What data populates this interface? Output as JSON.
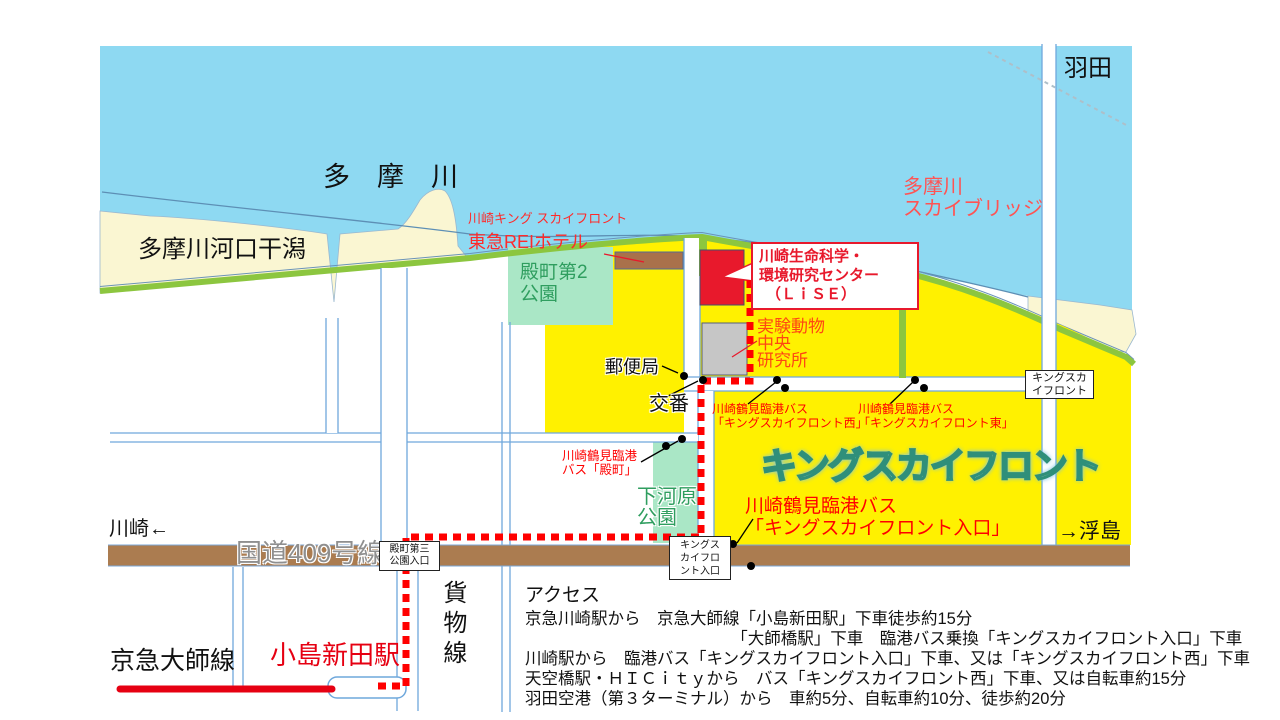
{
  "map": {
    "colors": {
      "river": "#8ed9f2",
      "sand": "#faf6d2",
      "shore_green": "#8cc63f",
      "district_yellow": "#fff100",
      "park_green": "#aae7c6",
      "road_brown": "#ab7c50",
      "road_line_blue": "#6fa8dc",
      "route_red": "#ff0000",
      "lise_building_red": "#e8192c",
      "rail_red": "#e60012"
    },
    "labels": {
      "haneda": "羽田",
      "tama_river": "多　摩　川",
      "tidal_flat": "多摩川河口干潟",
      "sky_bridge_1": "多摩川",
      "sky_bridge_2": "スカイブリッジ",
      "hotel_1": "川崎キング スカイフロント",
      "hotel_2": "東急REIホテル",
      "tonomachi_park_1": "殿町第2",
      "tonomachi_park_2": "公園",
      "lise_1": "川崎生命科学・",
      "lise_2": "環境研究センター",
      "lise_3": "（ＬｉＳＥ）",
      "animal_1": "実験動物",
      "animal_2": "中央",
      "animal_3": "研究所",
      "post_office": "郵便局",
      "koban": "交番",
      "bus_west_1": "川崎鶴見臨港バス",
      "bus_west_2": "「キングスカイフロント西」",
      "bus_east_1": "川崎鶴見臨港バス",
      "bus_east_2": "「キングスカイフロント東」",
      "bus_tonomachi_1": "川崎鶴見臨港",
      "bus_tonomachi_2": "バス「殿町」",
      "king_skyfront_big": "キングスカイフロント",
      "king_box_1": "キングスカ",
      "king_box_2": "イフロント",
      "bus_entrance_1": "川崎鶴見臨港バス",
      "bus_entrance_2": "「キングスカイフロント入口」",
      "entrance_box_1": "キングス",
      "entrance_box_2": "カイフロ",
      "entrance_box_3": "ント入口",
      "shimogawara_1": "下河原",
      "shimogawara_2": "公園",
      "ukishima": "→浮島",
      "kawasaki": "川崎←",
      "route409": "国道409号線",
      "tonomachi3_1": "殿町第三",
      "tonomachi3_2": "公園入口",
      "freight_line": "貨物線",
      "keikyu_daishi_line": "京急大師線",
      "kojima_shinden_station": "小島新田駅"
    },
    "access": {
      "heading": "アクセス",
      "lines": [
        "京急川崎駅から　京急大師線「小島新田駅」下車徒歩約15分",
        "　　　　　　　　　　　　　「大師橋駅」下車　臨港バス乗換「キングスカイフロント入口」下車",
        "川崎駅から　臨港バス「キングスカイフロント入口」下車、又は「キングスカイフロント西」下車",
        "天空橋駅・ＨＩＣｉｔｙから　バス「キングスカイフロント西」下車、又は自転車約15分",
        "羽田空港（第３ターミナル）から　車約5分、自転車約10分、徒歩約20分"
      ]
    }
  }
}
